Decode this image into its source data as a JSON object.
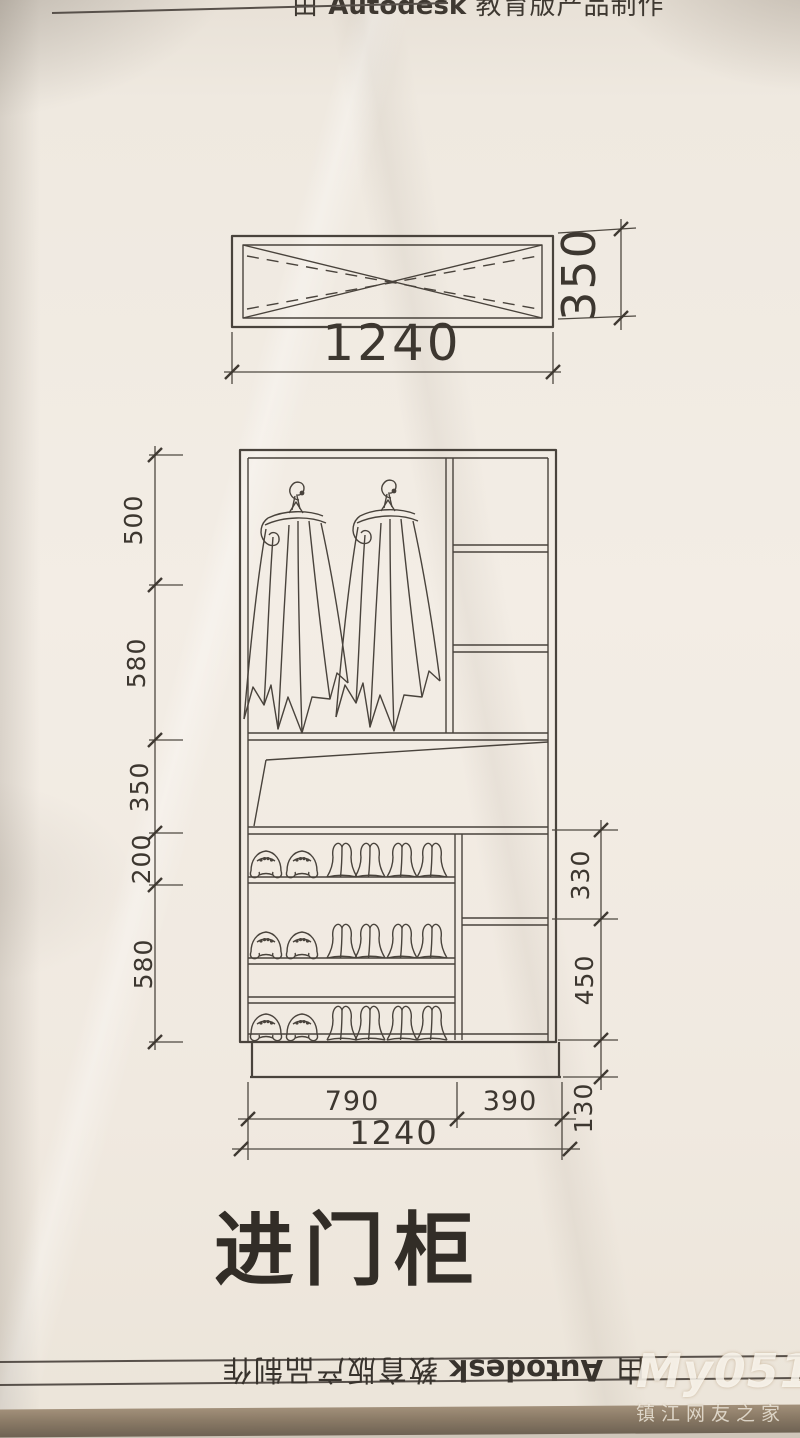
{
  "watermarks": {
    "autodesk_top": {
      "prefix": "由 ",
      "brand": "Autodesk",
      "suffix": " 教育版产品制作"
    },
    "autodesk_bottom": {
      "prefix": "由 ",
      "brand": "Autodesk",
      "suffix": " 教育版产品制作"
    },
    "site": {
      "logo": "My0511",
      "domain": ".COM",
      "subtitle": "镇江网友之家"
    }
  },
  "drawing": {
    "title": "进门柜",
    "top_cabinet": {
      "width": "1240",
      "height": "350"
    },
    "elevation": {
      "left_heights": [
        "500",
        "580",
        "350",
        "200",
        "580"
      ],
      "right_heights": [
        "330",
        "450"
      ],
      "plinth_height": "130",
      "bottom_widths": [
        "790",
        "390"
      ],
      "total_width": "1240"
    }
  }
}
